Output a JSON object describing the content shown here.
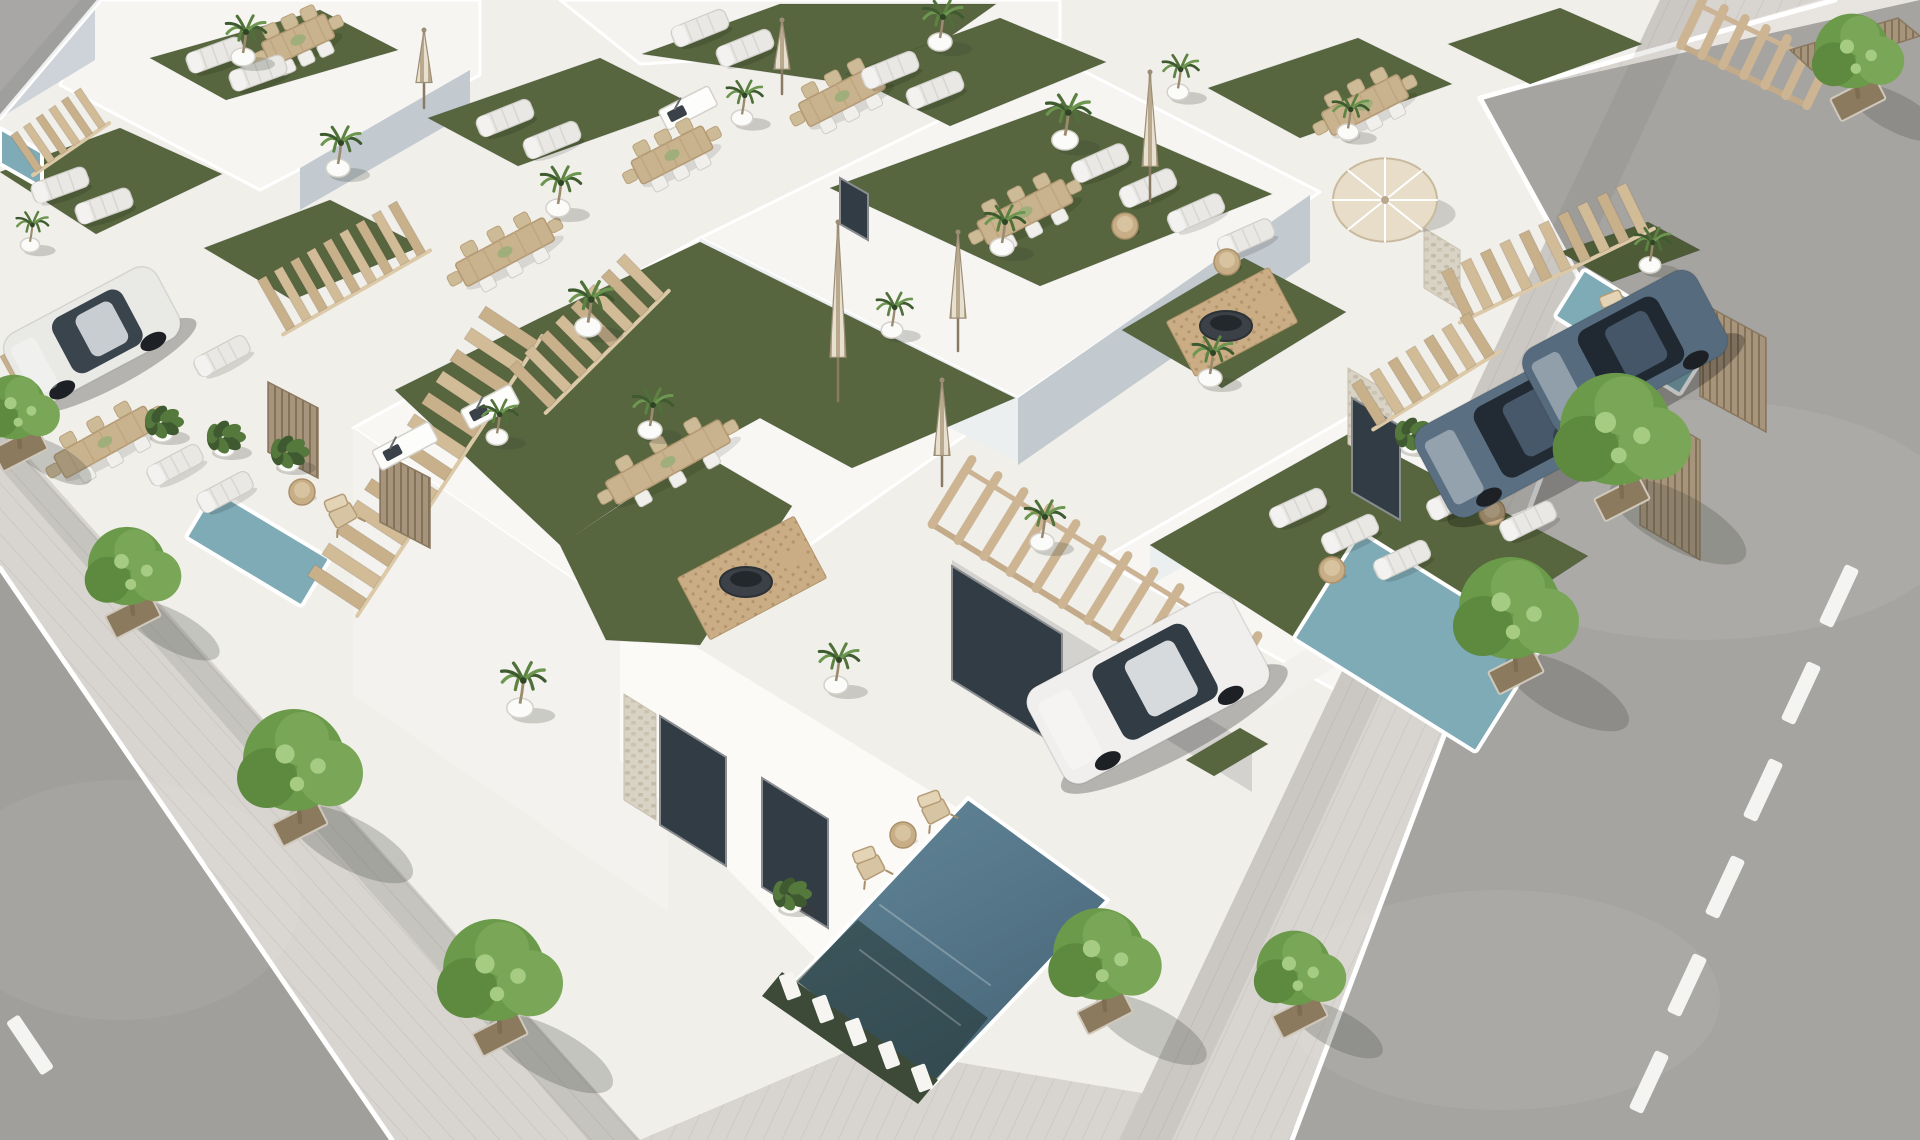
{
  "meta": {
    "description": "aerial-3d-render-of-white-villa-development-with-roof-terraces-pools-and-streets",
    "visible_text": []
  },
  "scene": {
    "canvas": {
      "w": 1920,
      "h": 1140
    },
    "palette": {
      "base": "#e8e5e0",
      "block": "#f1efea",
      "sidewalk": "#d8d5d0",
      "asphalt_right": "#a6a4a1",
      "asphalt_left": "#a19f9c",
      "asphalt_top": "#a8a7a5",
      "curb": "#ffffff",
      "turf": "#57663e",
      "turf_dark": "#4d5b37",
      "water_light": "#7fabb6",
      "water_deep_a": "#628799",
      "water_deep_b": "#49687a",
      "wood": "#cdb593",
      "wood_dark": "#b59c78",
      "wall_shade": "#c2c9cf",
      "canopy_a": "#6c9a4b",
      "canopy_b": "#5e8a40",
      "canopy_c": "#7aa757",
      "canopy_hi": "#a5cc82",
      "car_white": "#efeeec",
      "car_blue": "#5a7082",
      "glass": "#323c45"
    },
    "roads": [
      {
        "name": "road-top-left",
        "points": "0,0 100,0 0,118",
        "fill": "#a8a7a5"
      },
      {
        "name": "road-right",
        "points": "1480,98 1920,0 1920,1140 1292,1140 1601,318",
        "fill": "#a6a4a1"
      },
      {
        "name": "road-left",
        "points": "0,568 392,1140 0,1140",
        "fill": "#a19f9c"
      }
    ],
    "road_patches": [
      {
        "cx": 1700,
        "cy": 520,
        "rx": 260,
        "ry": 120,
        "o": 0.07
      },
      {
        "cx": 1500,
        "cy": 1000,
        "rx": 220,
        "ry": 110,
        "o": 0.06
      },
      {
        "cx": 120,
        "cy": 900,
        "rx": 180,
        "ry": 120,
        "o": 0.06
      }
    ],
    "curbs": [
      [
        0,
        568,
        392,
        1140
      ],
      [
        1601,
        318,
        1292,
        1140
      ],
      [
        1601,
        318,
        1480,
        98
      ],
      [
        1480,
        98,
        1835,
        0
      ],
      [
        100,
        0,
        0,
        118
      ]
    ],
    "dashes": {
      "left": [
        [
          30,
          1045
        ]
      ],
      "right": [
        [
          1763,
          790
        ],
        [
          1725,
          887
        ],
        [
          1687,
          985
        ],
        [
          1649,
          1082
        ],
        [
          1801,
          693
        ],
        [
          1839,
          596
        ]
      ],
      "rot_left": -34,
      "rot_right": 25,
      "w": 15,
      "h": 64
    },
    "sidewalks": [
      {
        "name": "sidewalk-left",
        "points": "0,425 640,1140 392,1140 0,568",
        "pattern": "paveA"
      },
      {
        "name": "sidewalk-right",
        "points": "1660,0 1820,0 1480,98 1601,318 1292,1140 1120,1140",
        "pattern": "paveB"
      },
      {
        "name": "sidewalk-bottom",
        "points": "640,1140 860,1046 1160,1096 1120,1140",
        "pattern": "paveB"
      }
    ],
    "block": {
      "points": "100,0 1660,0 1120,1140 860,1140 640,1140 0,568 0,425 0,118"
    },
    "slabs": [
      {
        "points": "353,428 700,238 1018,398 668,645",
        "fill": "#f8f7f4"
      },
      {
        "points": "700,238 1062,60 1320,192 1018,398",
        "fill": "#f6f5f2"
      },
      {
        "points": "1100,560 1352,415 1630,560 1380,715",
        "fill": "#f7f6f3"
      },
      {
        "points": "90,0 480,0 480,75 260,190 60,85",
        "fill": "#f6f5f2"
      },
      {
        "points": "560,0 1060,0 1060,40 640,64",
        "fill": "#f4f3f0"
      }
    ],
    "walls": [
      {
        "points": "300,168 470,70 470,112 300,210",
        "fill": "#c2c9cf"
      },
      {
        "points": "95,6 0,64 0,118 95,60",
        "fill": "#cdd3d8"
      },
      {
        "points": "1018,398 1310,195 1310,262 1018,465",
        "fill": "#c2c9cf"
      },
      {
        "points": "700,238 1018,398 1018,462 700,302",
        "fill": "#eceff0"
      },
      {
        "points": "1150,545 1360,430 1360,470 1150,585",
        "fill": "#eceff0"
      },
      {
        "points": "353,428 668,645 668,912 353,695",
        "fill": "#f4f2ee"
      },
      {
        "points": "620,600 1062,872 1062,952 896,1040 620,760",
        "fill": "#fbfaf7"
      },
      {
        "points": "1240,690 1450,560 1478,578 1268,708",
        "fill": "#f3f1ed"
      }
    ],
    "turfs": [
      {
        "name": "turf-roof-1",
        "points": "150,58 320,10 398,50 226,100"
      },
      {
        "name": "turf-roof-2",
        "points": "428,118 600,58 692,104 518,166"
      },
      {
        "name": "turf-roof-3",
        "points": "642,54 780,4 996,4 878,88"
      },
      {
        "name": "turf-roof-4",
        "points": "846,74 1000,18 1106,62 950,126"
      },
      {
        "name": "turf-roof-5",
        "points": "1208,88 1358,38 1452,84 1300,138"
      },
      {
        "name": "turf-roof-6",
        "points": "1448,44 1560,8 1642,44 1530,84"
      },
      {
        "name": "turf-roof-7",
        "points": "0,172 120,128 222,174 96,234"
      },
      {
        "name": "turf-roof-8",
        "points": "204,248 330,200 422,246 292,300"
      },
      {
        "name": "turf-roof-9",
        "points": "830,188 1062,103 1272,194 1040,286"
      },
      {
        "name": "turf-main-terrace",
        "points": "395,390 540,318 700,242 1015,398 852,468 760,418 698,452 560,545"
      },
      {
        "name": "turf-main-arm",
        "points": "560,545 700,452 792,506 700,645 606,640"
      },
      {
        "name": "turf-roof-right",
        "points": "1150,545 1352,432 1588,556 1380,692"
      },
      {
        "name": "turf-roof-right-2",
        "points": "1122,330 1244,258 1346,312 1222,388"
      },
      {
        "name": "turf-pool-strip",
        "points": "1560,252 1648,222 1700,250 1612,282",
        "fill": "#4d5b37"
      },
      {
        "name": "turf-drive-strip",
        "points": "1186,760 1240,728 1268,744 1214,776"
      }
    ],
    "pools": {
      "polys": [
        {
          "name": "pool-main",
          "points": "968,798 1108,900 930,1088 795,982",
          "grad": true
        },
        {
          "name": "pool-edge-left",
          "points": "0,128 42,152 42,188 0,164",
          "grad": false
        }
      ],
      "rects": [
        {
          "name": "pool-left-patio",
          "cx": 258,
          "cy": 548,
          "w": 135,
          "h": 56,
          "rot": 31
        },
        {
          "name": "pool-right-patio",
          "cx": 1418,
          "cy": 642,
          "w": 215,
          "h": 126,
          "rot": 32
        },
        {
          "name": "pool-top-right",
          "cx": 1632,
          "cy": 332,
          "w": 148,
          "h": 56,
          "rot": 32
        }
      ],
      "dark_overlay": "795,982 930,1088 988,1018 858,920",
      "fence_band": "782,972 938,1080 918,1104 762,996",
      "fence_line": {
        "x1": 790,
        "y1": 986,
        "x2": 922,
        "y2": 1078,
        "n": 5
      }
    },
    "stones": [
      "624,694 656,714 656,820 624,800",
      "1348,368 1392,394 1392,470 1348,444",
      "1424,228 1460,250 1460,310 1424,288"
    ],
    "doors": [
      "660,716 726,757 726,866 660,825",
      "762,778 828,819 828,928 762,887",
      "952,566 1062,634 1062,748 952,680",
      "1352,398 1400,426 1400,520 1352,492",
      "840,178 868,194 868,240 840,224"
    ],
    "stairs": [
      {
        "name": "stairs-topleft",
        "x1": 20,
        "y1": 156,
        "x2": 96,
        "y2": 104,
        "steps": 6,
        "w": 44
      },
      {
        "name": "stairs-left-edge",
        "x1": 6,
        "y1": 376,
        "x2": 82,
        "y2": 334,
        "steps": 5,
        "w": 40
      },
      {
        "name": "stairs-left-villa",
        "x1": 268,
        "y1": 308,
        "x2": 415,
        "y2": 224,
        "steps": 9,
        "w": 58
      },
      {
        "name": "stairs-main-long",
        "x1": 330,
        "y1": 598,
        "x2": 515,
        "y2": 318,
        "steps": 13,
        "w": 62
      },
      {
        "name": "stairs-second-villa",
        "x1": 525,
        "y1": 392,
        "x2": 648,
        "y2": 270,
        "steps": 8,
        "w": 56
      },
      {
        "name": "stairs-right-upper",
        "x1": 1448,
        "y1": 298,
        "x2": 1642,
        "y2": 204,
        "steps": 10,
        "w": 52
      },
      {
        "name": "stairs-right-lower",
        "x1": 1360,
        "y1": 408,
        "x2": 1486,
        "y2": 330,
        "steps": 7,
        "w": 48
      }
    ],
    "pergolas": [
      {
        "name": "pergola-main-entry",
        "x1": 952,
        "y1": 492,
        "x2": 1238,
        "y2": 668,
        "beams": 11,
        "len": 76
      },
      {
        "name": "pergola-topright",
        "x1": 1692,
        "y1": 22,
        "x2": 1818,
        "y2": 82,
        "beams": 6,
        "len": 52
      }
    ],
    "louvers": [
      "1640,405 1700,440 1700,560 1640,525",
      "1700,302 1766,338 1766,432 1700,396",
      "268,382 318,408 318,478 268,452",
      "380,452 430,478 430,548 380,522",
      "1790,50 1898,18 1920,36 1812,70"
    ],
    "kitchens": [
      [
        405,
        446,
        -28,
        64
      ],
      [
        490,
        407,
        -28,
        56
      ],
      [
        688,
        108,
        -27,
        56
      ]
    ],
    "firepits": [
      [
        752,
        578,
        -28,
        132,
        70
      ],
      [
        1232,
        322,
        -28,
        116,
        62
      ]
    ],
    "dining": [
      [
        668,
        462,
        -29,
        130
      ],
      [
        1025,
        212,
        -27,
        96
      ],
      [
        842,
        96,
        -27,
        86
      ],
      [
        672,
        155,
        -27,
        80
      ],
      [
        505,
        252,
        -28,
        100
      ],
      [
        298,
        40,
        -25,
        70
      ],
      [
        1365,
        105,
        -27,
        86
      ],
      [
        105,
        442,
        -29,
        104
      ]
    ],
    "loungers": [
      [
        215,
        55,
        -20
      ],
      [
        258,
        73,
        -20
      ],
      [
        505,
        118,
        -22
      ],
      [
        552,
        140,
        -22
      ],
      [
        700,
        28,
        -22
      ],
      [
        745,
        48,
        -22
      ],
      [
        890,
        70,
        -22
      ],
      [
        935,
        90,
        -22
      ],
      [
        1100,
        163,
        -24
      ],
      [
        1148,
        188,
        -24
      ],
      [
        1196,
        213,
        -24
      ],
      [
        1246,
        238,
        -24
      ],
      [
        1298,
        508,
        -25
      ],
      [
        1350,
        534,
        -25
      ],
      [
        1402,
        560,
        -25
      ],
      [
        60,
        185,
        -20
      ],
      [
        104,
        206,
        -20
      ],
      [
        175,
        465,
        -28
      ],
      [
        225,
        492,
        -28
      ],
      [
        222,
        356,
        -28
      ],
      [
        1455,
        500,
        -26
      ],
      [
        1528,
        521,
        -26
      ]
    ],
    "side_tables": [
      [
        1125,
        226
      ],
      [
        1227,
        262
      ],
      [
        1332,
        570
      ],
      [
        302,
        492
      ],
      [
        903,
        835
      ],
      [
        1492,
        512
      ]
    ],
    "deck_chairs": [
      [
        868,
        862,
        -28
      ],
      [
        933,
        806,
        -28
      ],
      [
        340,
        510,
        -30
      ],
      [
        1615,
        306,
        -30
      ]
    ],
    "parasols_closed": [
      [
        838,
        222,
        165
      ],
      [
        942,
        380,
        92
      ],
      [
        1150,
        72,
        115
      ],
      [
        424,
        30,
        64
      ],
      [
        782,
        20,
        60
      ],
      [
        958,
        232,
        105
      ]
    ],
    "parasols_open": [
      [
        1385,
        200,
        52
      ]
    ],
    "plants": [
      [
        162,
        428
      ],
      [
        224,
        443
      ],
      [
        288,
        458
      ],
      [
        790,
        900
      ],
      [
        1080,
        695
      ],
      [
        1412,
        440
      ]
    ],
    "palms": [
      [
        243,
        57,
        1.0
      ],
      [
        338,
        168,
        1.0
      ],
      [
        558,
        208,
        1.0
      ],
      [
        742,
        118,
        0.9
      ],
      [
        940,
        42,
        1.0
      ],
      [
        588,
        327,
        1.1
      ],
      [
        650,
        430,
        1.0
      ],
      [
        497,
        437,
        0.9
      ],
      [
        520,
        708,
        1.1
      ],
      [
        836,
        685,
        1.0
      ],
      [
        1065,
        140,
        1.1
      ],
      [
        1002,
        247,
        1.0
      ],
      [
        892,
        330,
        0.9
      ],
      [
        1178,
        92,
        0.9
      ],
      [
        1348,
        132,
        0.9
      ],
      [
        1210,
        378,
        1.0
      ],
      [
        1042,
        542,
        1.0
      ],
      [
        1468,
        448,
        1.0
      ],
      [
        1650,
        265,
        0.9
      ],
      [
        30,
        245,
        0.8
      ]
    ],
    "cars": [
      {
        "name": "car-white-small",
        "cx": 92,
        "cy": 336,
        "rot": -28,
        "len": 172,
        "wid": 80,
        "body": "#e9e9e6",
        "roof": "#c8cdd2",
        "glass": "#3a444d"
      },
      {
        "name": "car-white-large",
        "cx": 1148,
        "cy": 688,
        "rot": -28,
        "len": 232,
        "wid": 108,
        "body": "#f0efed",
        "roof": "#d6dadd",
        "glass": "#323c45"
      },
      {
        "name": "car-suv-blue-front",
        "cx": 1524,
        "cy": 430,
        "rot": -28,
        "len": 208,
        "wid": 102,
        "body": "#5a7082",
        "roof": "#46586a",
        "glass": "#222b33"
      },
      {
        "name": "car-suv-blue-back",
        "cx": 1625,
        "cy": 352,
        "rot": -28,
        "len": 196,
        "wid": 96,
        "body": "#566c7e",
        "roof": "#445668",
        "glass": "#202931"
      }
    ],
    "trees": [
      [
        20,
        445,
        38
      ],
      [
        133,
        612,
        46
      ],
      [
        300,
        820,
        60
      ],
      [
        500,
        1030,
        60
      ],
      [
        1622,
        495,
        66
      ],
      [
        1516,
        668,
        60
      ],
      [
        1300,
        1012,
        44
      ],
      [
        1105,
        1008,
        54
      ],
      [
        1858,
        95,
        44
      ]
    ],
    "shadows": [
      {
        "points": "0,430 640,1140 588,1140 0,468",
        "fill": "rgba(90,92,88,0.14)"
      },
      {
        "points": "1660,0 1120,1140 1172,1140 1704,0",
        "fill": "rgba(90,92,88,0.10)"
      },
      {
        "points": "952,560 1252,745 1252,792 952,607",
        "fill": "rgba(60,65,70,0.16)"
      },
      {
        "points": "100,0 0,118 0,92 80,0",
        "fill": "rgba(90,92,88,0.10)"
      }
    ]
  }
}
